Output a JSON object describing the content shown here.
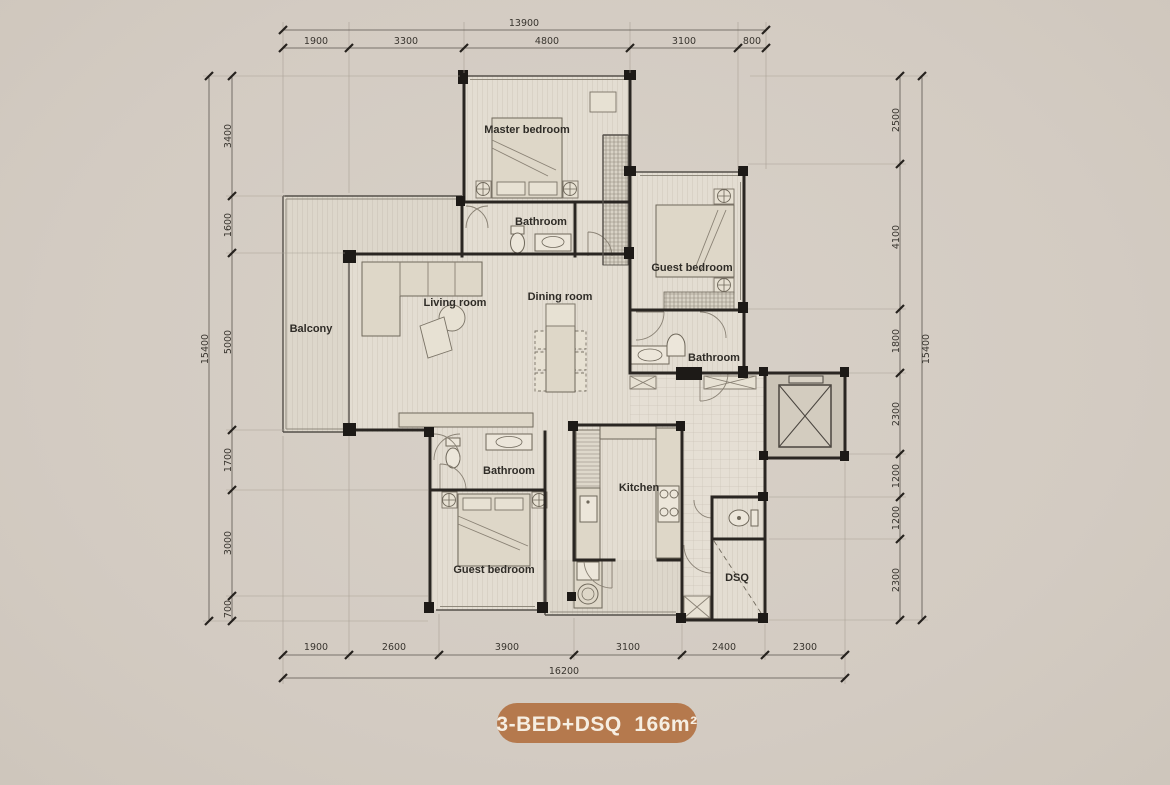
{
  "page": {
    "background": "#d4ccc3",
    "wall_color": "#2a2622"
  },
  "badge": {
    "label": "3-BED+DSQ  166m²",
    "bg": "#b5794d",
    "text_color": "#f6eee2"
  },
  "rooms": {
    "master_bedroom": {
      "label": "Master bedroom"
    },
    "master_bathroom": {
      "label": "Bathroom"
    },
    "guest_bedroom_right": {
      "label": "Guest bedroom"
    },
    "guest_bathroom_right": {
      "label": "Bathroom"
    },
    "living_room": {
      "label": "Living room"
    },
    "dining_room": {
      "label": "Dining room"
    },
    "balcony": {
      "label": "Balcony"
    },
    "lower_bathroom": {
      "label": "Bathroom"
    },
    "guest_bedroom_lower": {
      "label": "Guest bedroom"
    },
    "kitchen": {
      "label": "Kitchen"
    },
    "dsq": {
      "label": "DSQ"
    }
  },
  "dimensions": {
    "top": {
      "total": "13900",
      "segments": [
        "1900",
        "3300",
        "4800",
        "3100",
        "800"
      ]
    },
    "bottom": {
      "total": "16200",
      "segments": [
        "1900",
        "2600",
        "3900",
        "3100",
        "2400",
        "2300"
      ]
    },
    "left": {
      "total": "15400",
      "segments": [
        "3400",
        "1600",
        "5000",
        "1700",
        "3000",
        "700"
      ]
    },
    "right": {
      "total": "15400",
      "segments": [
        "2500",
        "4100",
        "1800",
        "2300",
        "1200",
        "1200",
        "2300"
      ]
    }
  }
}
